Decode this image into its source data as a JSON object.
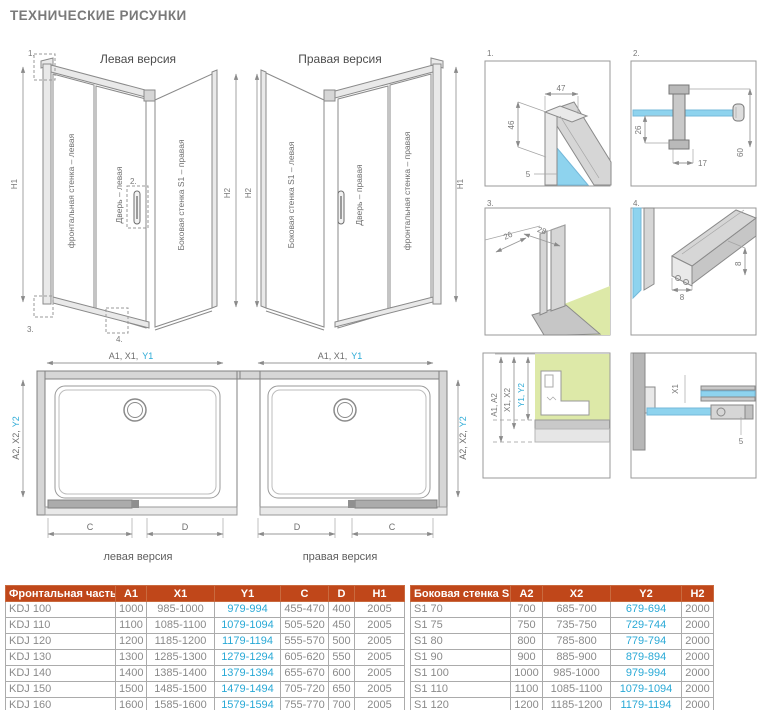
{
  "page": {
    "title": "ТЕХНИЧЕСКИЕ РИСУНКИ"
  },
  "colors": {
    "header_bg": "#c0471a",
    "cyan": "#29a9d6",
    "text_gray": "#8a8a8a",
    "glass": "#8ed3ee",
    "green": "#dde9a8",
    "title": "#7a7a7a"
  },
  "iso_left": {
    "caption": "Левая версия",
    "panel_front": "фронтальная стенка – левая",
    "panel_door": "Дверь – левая",
    "panel_side": "Боковая стенка S1 – правая",
    "dim_left": "H1",
    "dim_right": "H2",
    "callout_1": "1.",
    "callout_2": "2.",
    "callout_3": "3.",
    "callout_4": "4."
  },
  "iso_right": {
    "caption": "Правая версия",
    "panel_side": "Боковая стенка S1 – левая",
    "panel_door": "Дверь – правая",
    "panel_front": "фронтальная стенка – правая",
    "dim_left": "H2",
    "dim_right": "H1"
  },
  "details": {
    "d1": {
      "label": "1.",
      "dim_width": "47",
      "dim_height": "46",
      "dim_glass": "5"
    },
    "d2": {
      "label": "2.",
      "dim_depth": "26",
      "dim_offset": "17",
      "dim_height": "60"
    },
    "d3": {
      "label": "3.",
      "dim_depth": "26",
      "dim_width": "28"
    },
    "d4": {
      "label": "4.",
      "dim_height": "8",
      "dim_width": "8"
    },
    "wall_profile": {
      "dim_a": "A1, A2",
      "dim_x": "X1, X2",
      "dim_y": "Y1, Y2"
    },
    "plan_section": {
      "dim_x": "X1",
      "dim_glass": "5"
    }
  },
  "plan_left": {
    "dim_top": "A1, X1,",
    "dim_top_cyan": "Y1",
    "dim_side": "A2, X2,",
    "dim_side_cyan": "Y2",
    "dim_fixed": "C",
    "dim_door": "D",
    "caption": "левая версия"
  },
  "plan_right": {
    "dim_top": "A1, X1,",
    "dim_top_cyan": "Y1",
    "dim_side": "A2, X2,",
    "dim_side_cyan": "Y2",
    "dim_door": "D",
    "dim_fixed": "C",
    "caption": "правая версия"
  },
  "tables": {
    "front": {
      "headers": [
        "Фронтальная часть",
        "A1",
        "X1",
        "Y1",
        "C",
        "D",
        "H1"
      ],
      "rows": [
        [
          "KDJ 100",
          "1000",
          "985-1000",
          "979-994",
          "455-470",
          "400",
          "2005"
        ],
        [
          "KDJ 110",
          "1100",
          "1085-1100",
          "1079-1094",
          "505-520",
          "450",
          "2005"
        ],
        [
          "KDJ 120",
          "1200",
          "1185-1200",
          "1179-1194",
          "555-570",
          "500",
          "2005"
        ],
        [
          "KDJ 130",
          "1300",
          "1285-1300",
          "1279-1294",
          "605-620",
          "550",
          "2005"
        ],
        [
          "KDJ 140",
          "1400",
          "1385-1400",
          "1379-1394",
          "655-670",
          "600",
          "2005"
        ],
        [
          "KDJ 150",
          "1500",
          "1485-1500",
          "1479-1494",
          "705-720",
          "650",
          "2005"
        ],
        [
          "KDJ 160",
          "1600",
          "1585-1600",
          "1579-1594",
          "755-770",
          "700",
          "2005"
        ]
      ]
    },
    "side": {
      "headers": [
        "Боковая стенка S1",
        "A2",
        "X2",
        "Y2",
        "H2"
      ],
      "rows": [
        [
          "S1 70",
          "700",
          "685-700",
          "679-694",
          "2000"
        ],
        [
          "S1 75",
          "750",
          "735-750",
          "729-744",
          "2000"
        ],
        [
          "S1 80",
          "800",
          "785-800",
          "779-794",
          "2000"
        ],
        [
          "S1 90",
          "900",
          "885-900",
          "879-894",
          "2000"
        ],
        [
          "S1 100",
          "1000",
          "985-1000",
          "979-994",
          "2000"
        ],
        [
          "S1 110",
          "1100",
          "1085-1100",
          "1079-1094",
          "2000"
        ],
        [
          "S1 120",
          "1200",
          "1185-1200",
          "1179-1194",
          "2000"
        ]
      ]
    }
  }
}
